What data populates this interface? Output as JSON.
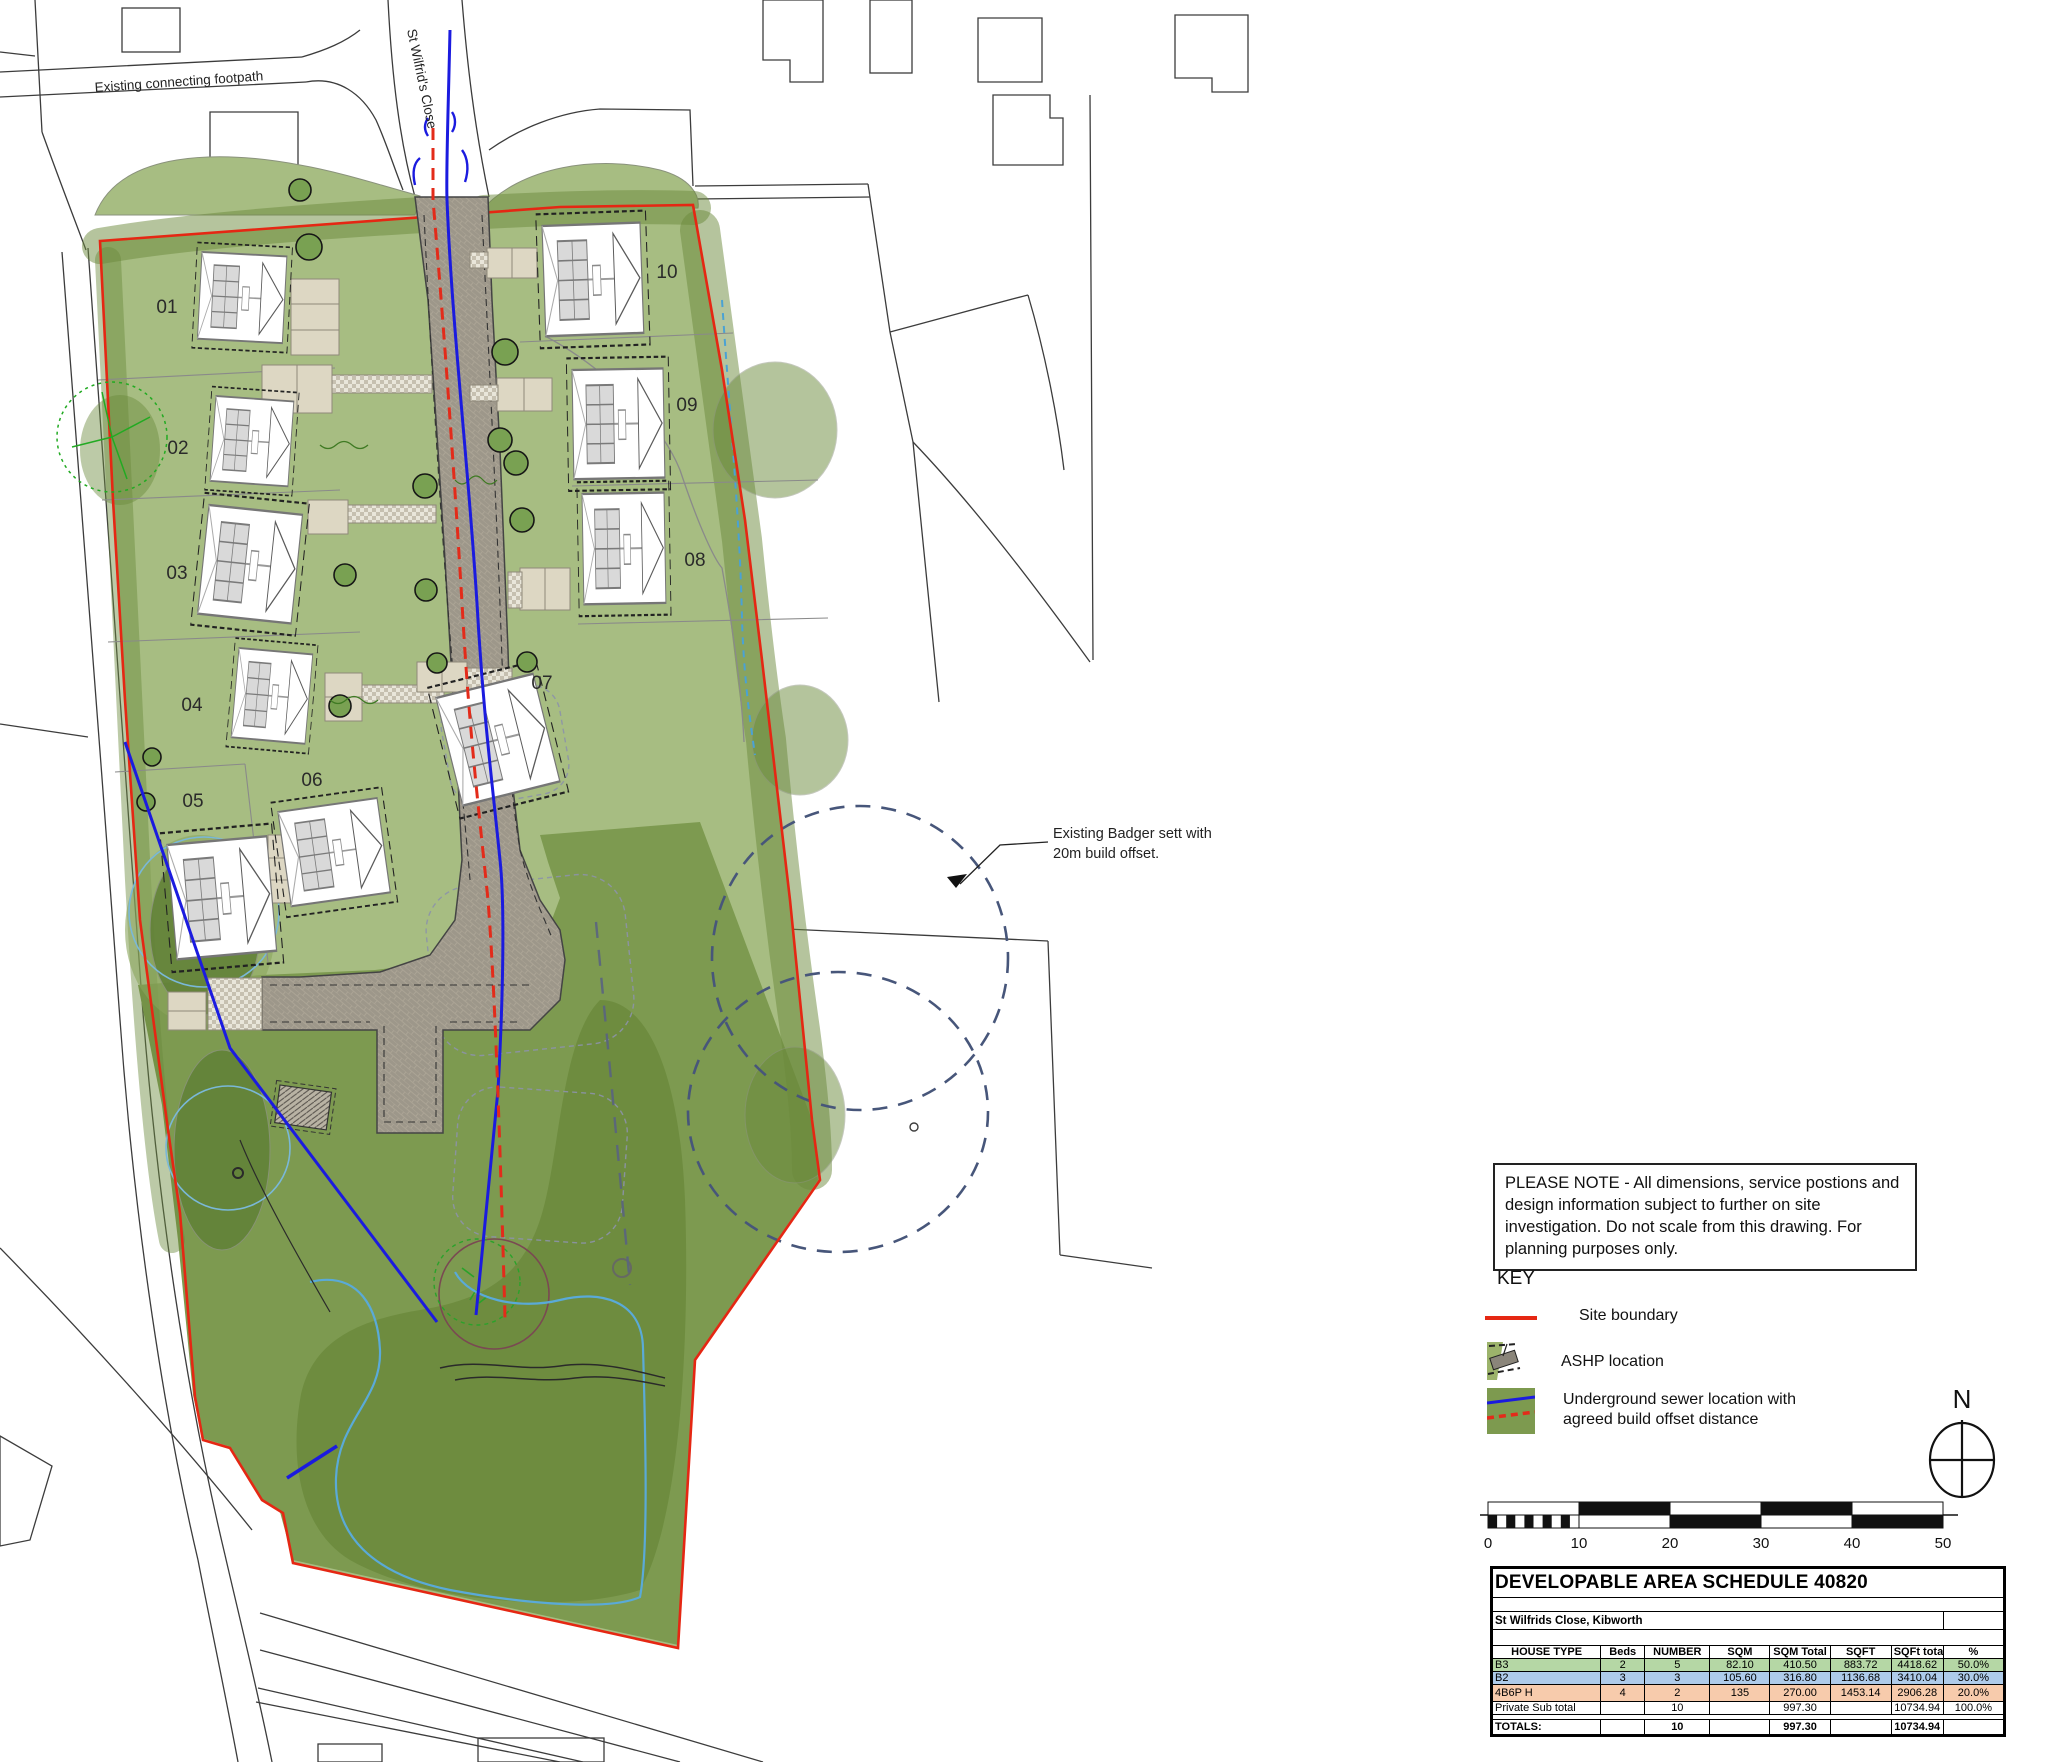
{
  "colors": {
    "site_boundary": "#e52713",
    "sewer_blue": "#1b1bdf",
    "offset_red": "#e32b1a",
    "grass_light": "#a7bd82",
    "grass_mid": "#7d9a50",
    "grass_dark": "#6b8a3c",
    "road_grey": "#9d978a",
    "row_green": "#b5d7a5",
    "row_blue": "#aecbea",
    "row_orange": "#f7cbac"
  },
  "plan": {
    "street_label": "St Wilfrid's Close",
    "footpath_label": "Existing connecting footpath",
    "badger_note_line1": "Existing Badger sett with",
    "badger_note_line2": "20m build offset.",
    "plots": [
      {
        "label": "01"
      },
      {
        "label": "02"
      },
      {
        "label": "03"
      },
      {
        "label": "04"
      },
      {
        "label": "05"
      },
      {
        "label": "06"
      },
      {
        "label": "07"
      },
      {
        "label": "08"
      },
      {
        "label": "09"
      },
      {
        "label": "10"
      }
    ]
  },
  "note_box": {
    "text": "PLEASE NOTE - All dimensions, service postions and design information subject to further on site investigation. Do not scale from this drawing. For planning purposes only."
  },
  "key": {
    "title": "KEY",
    "items": [
      {
        "icon": "site-boundary-line",
        "label": "Site boundary"
      },
      {
        "icon": "ashp-map-swatch",
        "label": "ASHP location"
      },
      {
        "icon": "sewer-offset-swatch",
        "label": "Underground sewer location with agreed build offset distance"
      }
    ]
  },
  "compass": {
    "label": "N"
  },
  "scale_bar": {
    "ticks": [
      "0",
      "10",
      "20",
      "30",
      "40",
      "50"
    ]
  },
  "table": {
    "title": "DEVELOPABLE AREA SCHEDULE 40820",
    "subtitle": "St Wilfrids Close, Kibworth",
    "headers": [
      "HOUSE TYPE",
      "Beds",
      "NUMBER",
      "SQM",
      "SQM Total",
      "SQFT",
      "SQFt total",
      "%"
    ],
    "rows": [
      [
        "B3",
        "2",
        "5",
        "82.10",
        "410.50",
        "883.72",
        "4418.62",
        "50.0%"
      ],
      [
        "B2",
        "3",
        "3",
        "105.60",
        "316.80",
        "1136.68",
        "3410.04",
        "30.0%"
      ],
      [
        "4B6P H",
        "4",
        "2",
        "135",
        "270.00",
        "1453.14",
        "2906.28",
        "20.0%"
      ],
      [
        "Private Sub total",
        "",
        "10",
        "",
        "997.30",
        "",
        "10734.94",
        "100.0%"
      ]
    ],
    "row_styles": [
      "background:#b5d7a5",
      "background:#aecbea",
      "background:#f7cbac",
      "background:#ffffff"
    ],
    "totals_row": [
      "TOTALS:",
      "",
      "10",
      "",
      "997.30",
      "",
      "10734.94",
      ""
    ]
  }
}
